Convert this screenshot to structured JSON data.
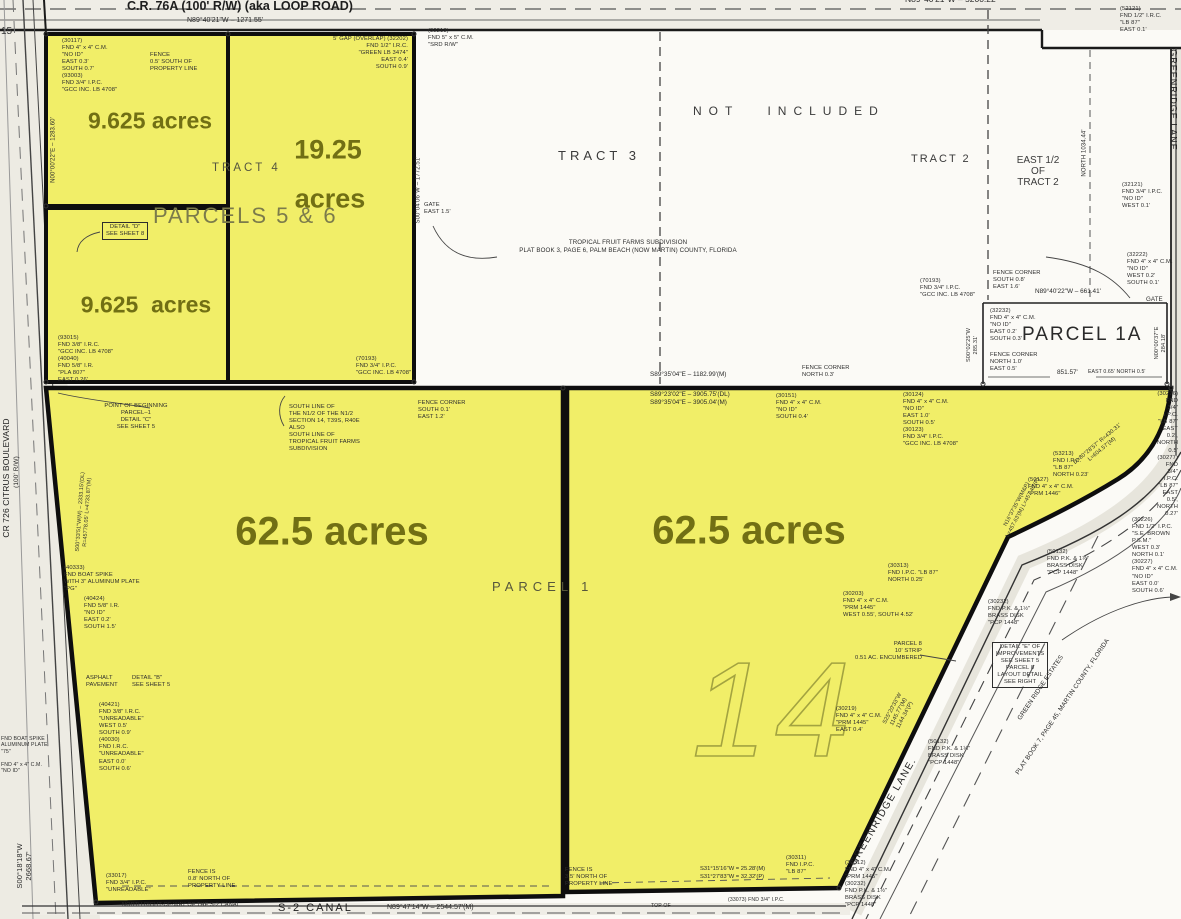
{
  "map": {
    "roads": {
      "cr76a": "C.R. 76A (100' R/W) (aka LOOP ROAD)",
      "cr76a_bearing": "N89°40'21\"W – 1271.55'",
      "north_bearing": "N89°40'21\"W – 5200.22'",
      "citrus_blvd_line1": "CR 726 CITRUS BOULEVARD",
      "citrus_blvd_line2": "(100' R/W)",
      "citrus_bearing": "S00°18'18\"W\n2668.67'",
      "greenridge_vertical": "GREENRIDGE LANE",
      "greenridge_diagonal": "GREENRIDGE LANE.",
      "s2_canal": "S-2 CANAL",
      "s2_row": "NORTH RIGHT-OF-WAY OF THE S-2 CANAL",
      "s2_bearing": "N89°47'14\"W – 2544.57'(M)",
      "edge_15": "15"
    },
    "labels": {
      "not_included": "NOT INCLUDED",
      "tract_2": "TRACT 2",
      "tract_3": "TRACT 3",
      "tract_4": "TRACT 4",
      "east_half": "EAST 1/2\nOF\nTRACT 2",
      "parcels_5_6": "PARCELS 5 & 6",
      "parcel_1": "PARCEL 1",
      "parcel_1a": "PARCEL 1A",
      "section_number": "14"
    },
    "acreage": {
      "top_left": "9.625 acres",
      "mid_left": "9.625  acres",
      "tall_line1": "19.25",
      "tall_line2": "acres",
      "west_62": "62.5 acres",
      "east_62": "62.5 acres"
    },
    "bearings": {
      "south_line_m": "S89°35'04\"E – 1182.99'(M)",
      "south_line_dl": "S89°23'02\"E – 3905.75'(DL)\nS89°35'04\"E – 3905.04'(M)",
      "p1a_bearing": "N89°40'22\"W – 661.41'",
      "p1a_851": "851.57'"
    },
    "dims": {
      "west_1283": "N00°00'22\"E – 1283.60'",
      "east_1772": "S00°04'06\"W – 1772.51'",
      "p1a_west": "S00°02'25\"W\n285.31'",
      "p1a_east": "N00°00'37\"E\n284.18'",
      "north_1034": "NORTH 1034.44'",
      "curve_main": "D=80°28'57\"  R=430.31'\nL=604.57'(M)",
      "lane_upper": "N16°37'35\"W(M&P)\nL=457.63'(M)  L=457.40'(P)",
      "lane_lower": "S25°20'33\"W\n1145.77'(M)\n1144.34'(P)",
      "west_curve": "S00°33'51\"W(M) – 2333.15'(DL)\nR=45778.05'   L=4733.87'(M)",
      "corner_sw": "S31°15'16\"W = 25.28'(M)\nS31°27'83\"W = 32.32'(P)"
    },
    "plat": {
      "subdivision_note": "TROPICAL FRUIT FARMS SUBDIVISION\nPLAT BOOK 3, PAGE 6, PALM BEACH (NOW MARTIN) COUNTY, FLORIDA",
      "green_ridge_estates": "GREEN RIDGE ESTATES",
      "green_ridge_plat": "PLAT BOOK 7, PAGE 45, MARTIN COUNTY, FLORIDA"
    },
    "notes": [
      "(30117)\nFND 4\" x 4\" C.M.\n\"NO ID\"\nEAST 0.3'\nSOUTH 0.7'\n(93003)\nFND 3/4\" I.P.C.\n\"GCC INC. LB 4708\"",
      "FENCE\n0.5' SOUTH OF\nPROPERTY LINE",
      "5' GAP (OVERLAP)   (32202)\nFND 1/2\" I.R.C.\n\"GREEN LB 3474\"\nEAST 0.4'\nSOUTH 0.9'",
      "(32213)\nFND 5\" x 5\" C.M.\n\"SRD R/W\"",
      "DETAIL \"D\"\nSEE SHEET 8",
      "(93015)\nFND 3/8\" I.R.C.\n\"GCC INC. LB 4708\"\n(40040)\nFND 5/8\" I.R.\n\"PLA 807\"\nEAST 0.26'",
      "(70193)\nFND 3/4\" I.P.C.\n\"GCC INC. LB 4708\"",
      "GATE\nEAST 1.5'",
      "FENCE CORNER\nSOUTH 0.1'\nEAST 1.2'",
      "POINT OF BEGINNING\nPARCEL–1\nDETAIL \"C\"\nSEE SHEET 5",
      "SOUTH LINE OF\nTHE N1/2 OF THE N1/2\nSECTION 14, T39S, R40E\nALSO\nSOUTH LINE OF\nTROPICAL FRUIT FARMS\nSUBDIVISION",
      "FENCE CORNER\nNORTH 0.3'",
      "(30151)\nFND 4\" x 4\" C.M.\n\"NO ID\"\nSOUTH 0.4'",
      "(30124)\nFND 4\" x 4\" C.M.\n\"NO ID\"\nEAST 1.0'\nSOUTH 0.5'\n(30123)\nFND 3/4\" I.P.C.\n\"GCC INC. LB 4708\"",
      "(30276) FND 3/4\" I.P.C. \"LB 87\"\nEAST 0.2', NORTH 0.5'\n(30277) FND 3/4\" I.P.C. \"LB 87\"\nEAST 0.5', NORTH 0.27'",
      "FENCE CORNER\nSOUTH 0.8'\nEAST 1.6'",
      "(70193)\nFND 3/4\" I.P.C.\n\"GCC INC. LB 4708\"",
      "(32232)\nFND 4\" x 4\" C.M.\n\"NO ID\"\nEAST 0.2'\nSOUTH 0.3'",
      "FENCE CORNER\nNORTH 1.0'\nEAST 0.5'",
      "EAST 0.65'   NORTH 0.5'",
      "(32222)\nFND 4\" x 4\" C.M.\n\"NO ID\"\nWEST 0.2'\nSOUTH 0.1'",
      "GATE",
      "(52121)\nFND 1/2\" I.R.C.\n\"LB 87\"\nEAST 0.1'",
      "(32121)\nFND 3/4\" I.P.C.\n\"NO ID\"\nWEST 0.1'",
      "(53213)\nFND I.P.C.\n\"LB 87\"\nNORTH 0.23'",
      "(50127)\nFND 4\" x 4\" C.M.\n\"PRM 1446\"",
      "(50132)\nFND P.K. & 1½\"\nBRASS DISK\n\"PCP 1448\"",
      "(30232)\nFND P.K. & 1½\"\nBRASS DISK\n\"PCP 1448\"",
      "(30226)\nFND 1/2\" I.P.C.\n\"S.E. BROWN P.S.M.\"\nWEST 0.3'\nNORTH 0.1'\n(30227)\nFND 4\" x 4\" C.M.\n\"NO ID\"\nEAST 0.0'\nSOUTH 0.6'",
      "DETAIL \"E\" OF\nIMPROVEMENTS\nSEE SHEET 5\nPARCEL 8\nLAYOUT DETAIL\nSEE RIGHT",
      "PARCEL 8\n10' STRIP\n0.51 AC. ENCUMBERED",
      "(30219)\nFND 4\" x 4\" C.M.\n\"PRM 1445\"\nEAST 0.4'",
      "(30313)\nFND I.P.C. \"LB 87\"\nNORTH 0.25'",
      "(30203)\nFND 4\" x 4\" C.M.\n\"PRM 1445\"\nWEST 0.55', SOUTH 4.52'",
      "(50132)\nFND P.K. & 1¼\"\nBRASS DISK\n\"PCP 1448\"",
      "(40333)\nFND BOAT SPIKE\nWITH 3\" ALUMINUM PLATE\n\"PG\"",
      "(40424)\nFND 5/8\" I.R.\n\"NO ID\"\nEAST 0.2'\nSOUTH 1.5'",
      "ASPHALT\nPAVEMENT",
      "DETAIL \"B\"\nSEE SHEET 5",
      "(40421)\nFND 3/8\" I.R.C.\n\"UNREADABLE\"\nWEST 0.5'\nSOUTH 0.9'\n(40030)\nFND I.R.C.\n\"UNREADABLE\"\nEAST 0.0'\nSOUTH 0.6'",
      "(33017)\nFND 3/4\" I.P.C.\n\"UNREADABLE\"",
      "FENCE IS\n0.8' NORTH OF\nPROPERTY LINE",
      "FENCE IS\n3.5' NORTH OF\nPROPERTY LINE",
      "(30311)\nFND I.P.C.\n\"LB 87\"",
      "(30312)\nFND 4\" x 4\" C.M.\n\"PRM 1445\"\n(30232)\nFND P.K. & 1½\"\nBRASS DISK\n\"PCP 1448\"",
      "(33073)   FND 3/4\" I.P.C.",
      "TOP OF",
      "FND BOAT SPIKE\nALUMINUM PLATE\n\"75\"",
      "FND 4\" x 4\" C.M.\n\"NO ID\""
    ]
  }
}
